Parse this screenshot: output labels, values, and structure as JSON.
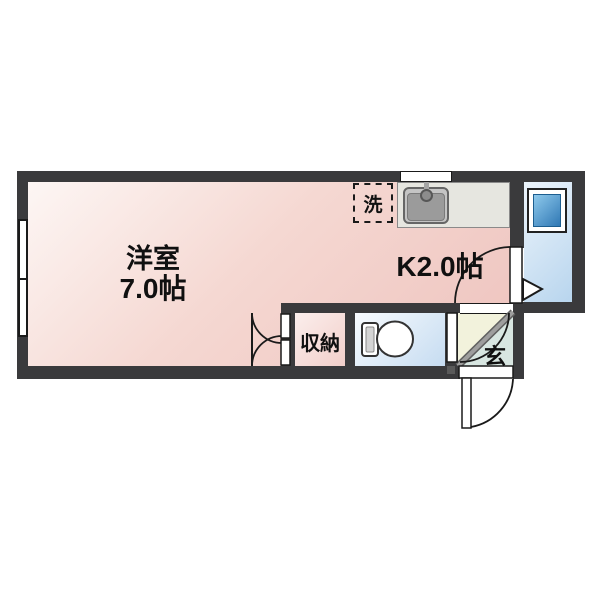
{
  "labels": {
    "western_room_name": "洋室",
    "western_room_size": "7.0帖",
    "kitchen": "K2.0帖",
    "closet": "収納",
    "laundry": "洗",
    "entrance": "玄"
  },
  "colors": {
    "wall": "#3a3a3c",
    "room_pink": "#eec3be",
    "bathroom_blue": "#b8d5ee",
    "toilet_blue": "#c6dcf1",
    "bath_window_blue": "#3078b4",
    "entrance_hall_cream": "#f2f2dc",
    "entrance_step_gray": "#8a8a8a",
    "counter_gray": "#e6e6e0"
  }
}
